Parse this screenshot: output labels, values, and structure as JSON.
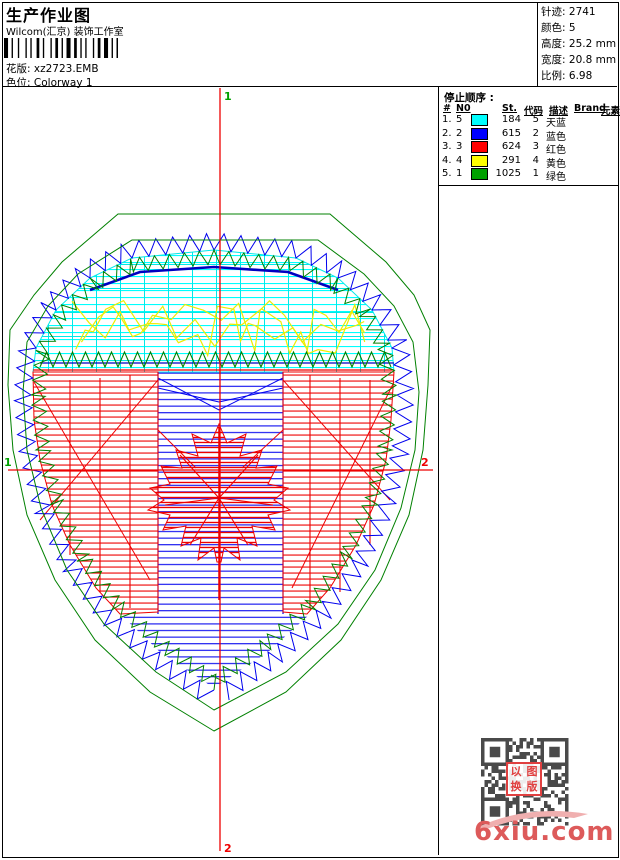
{
  "header": {
    "title": "生产作业图",
    "studio": "Wilcom(汇京) 装饰工作室",
    "design_label": "花版:",
    "design_value": "xz2723.EMB",
    "colorway_label": "色位:",
    "colorway_value": "Colorway 1"
  },
  "stats": [
    {
      "label": "针迹:",
      "value": "2741"
    },
    {
      "label": "颜色:",
      "value": "5"
    },
    {
      "label": "高度:",
      "value": "25.2 mm"
    },
    {
      "label": "宽度:",
      "value": "20.8 mm"
    },
    {
      "label": "比例:",
      "value": "6.98"
    }
  ],
  "stop_sequence": {
    "title": "停止顺序 :",
    "columns": [
      "#",
      "N0",
      "St.",
      "代码",
      "描述",
      "Brand",
      "元素"
    ],
    "rows": [
      {
        "seq": "1.",
        "n0": "5",
        "swatch": "#00FFFF",
        "st": "184",
        "code": "5",
        "desc": "天蓝",
        "brand": "",
        "element": ""
      },
      {
        "seq": "2.",
        "n0": "2",
        "swatch": "#0000FF",
        "st": "615",
        "code": "2",
        "desc": "蓝色",
        "brand": "",
        "element": ""
      },
      {
        "seq": "3.",
        "n0": "3",
        "swatch": "#FF0000",
        "st": "624",
        "code": "3",
        "desc": "红色",
        "brand": "",
        "element": ""
      },
      {
        "seq": "4.",
        "n0": "4",
        "swatch": "#FFFF00",
        "st": "291",
        "code": "4",
        "desc": "黄色",
        "brand": "",
        "element": ""
      },
      {
        "seq": "5.",
        "n0": "1",
        "swatch": "#00A000",
        "st": "1025",
        "code": "1",
        "desc": "绿色",
        "brand": "",
        "element": ""
      }
    ]
  },
  "crosshair": {
    "v_top_label": "1",
    "v_bottom_label": "2",
    "h_left_label": "1",
    "h_right_label": "2",
    "line_color": "#EE0000",
    "start_marker_color": "#00A000",
    "end_marker_color": "#EE0000"
  },
  "design_colors": {
    "cyan": "#00E8E8",
    "bright_cyan": "#00FFFF",
    "blue": "#0000EE",
    "dark_blue": "#0000C0",
    "red": "#EE0000",
    "yellow": "#EDED00",
    "green": "#008000",
    "qr_dark": "#4A4A4A"
  },
  "watermark": {
    "text": "6xiu.com",
    "color": "#DD5A5A",
    "swoosh_color": "#F0AFAF"
  },
  "qr_stamp": {
    "chars": "以图换版",
    "color": "#E04040"
  }
}
